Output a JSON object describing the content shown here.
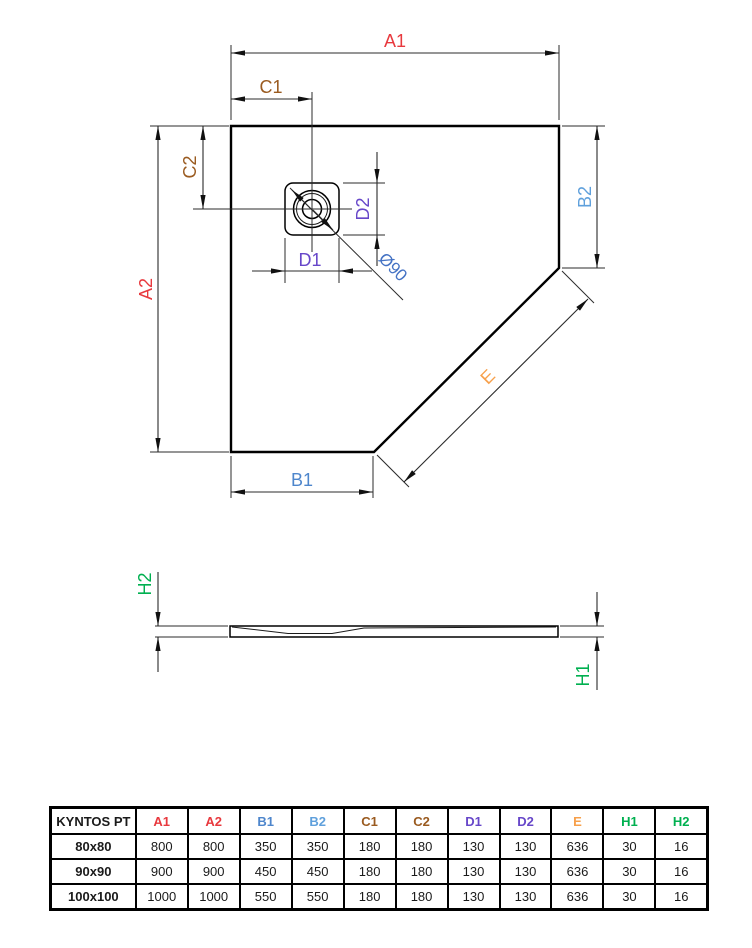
{
  "drawing": {
    "dims": {
      "a1": {
        "label": "A1",
        "color": "#E8393E"
      },
      "a2": {
        "label": "A2",
        "color": "#E8393E"
      },
      "b1": {
        "label": "B1",
        "color": "#4E86CC"
      },
      "b2": {
        "label": "B2",
        "color": "#5FA0DC"
      },
      "c1": {
        "label": "C1",
        "color": "#9A5B20"
      },
      "c2": {
        "label": "C2",
        "color": "#9A5B20"
      },
      "d1": {
        "label": "D1",
        "color": "#6747C9"
      },
      "d2": {
        "label": "D2",
        "color": "#6747C9"
      },
      "e": {
        "label": "E",
        "color": "#F7A04B"
      },
      "h1": {
        "label": "H1",
        "color": "#00B050"
      },
      "h2": {
        "label": "H2",
        "color": "#00B050"
      },
      "diameter": {
        "label": "Ø90",
        "color": "#4472C4"
      }
    }
  },
  "table": {
    "title": "KYNTOS PT",
    "columns": [
      {
        "label": "A1",
        "color": "#E8393E"
      },
      {
        "label": "A2",
        "color": "#E8393E"
      },
      {
        "label": "B1",
        "color": "#4E86CC"
      },
      {
        "label": "B2",
        "color": "#5FA0DC"
      },
      {
        "label": "C1",
        "color": "#9A5B20"
      },
      {
        "label": "C2",
        "color": "#9A5B20"
      },
      {
        "label": "D1",
        "color": "#6747C9"
      },
      {
        "label": "D2",
        "color": "#6747C9"
      },
      {
        "label": "E",
        "color": "#F7A04B"
      },
      {
        "label": "H1",
        "color": "#00B050"
      },
      {
        "label": "H2",
        "color": "#00B050"
      }
    ],
    "rows": [
      {
        "name": "80x80",
        "values": [
          "800",
          "800",
          "350",
          "350",
          "180",
          "180",
          "130",
          "130",
          "636",
          "30",
          "16"
        ]
      },
      {
        "name": "90x90",
        "values": [
          "900",
          "900",
          "450",
          "450",
          "180",
          "180",
          "130",
          "130",
          "636",
          "30",
          "16"
        ]
      },
      {
        "name": "100x100",
        "values": [
          "1000",
          "1000",
          "550",
          "550",
          "180",
          "180",
          "130",
          "130",
          "636",
          "30",
          "16"
        ]
      }
    ]
  }
}
